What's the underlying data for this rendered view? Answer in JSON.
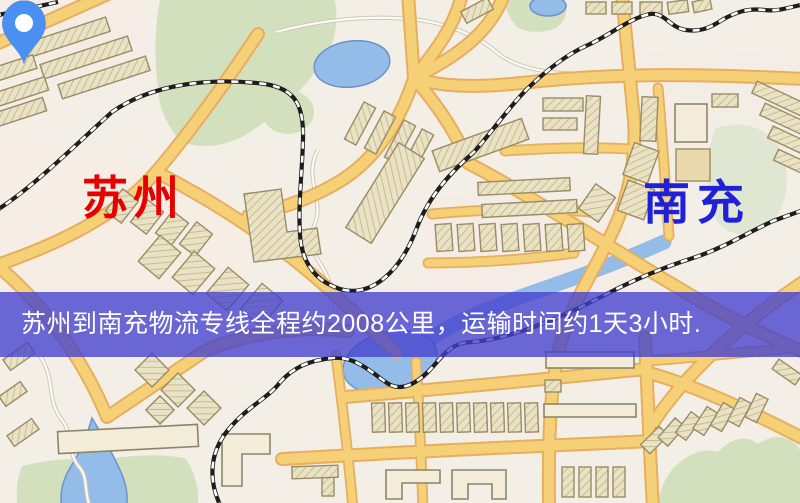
{
  "map": {
    "origin": {
      "name": "苏州",
      "marker_color": "#ee2a1d",
      "label_color": "#e60000"
    },
    "destination": {
      "name": "南充",
      "marker_color": "#4a8ff2",
      "label_color": "#2020d8"
    },
    "banner": {
      "text": "苏州到南充物流专线全程约2008公里，运输时间约1天3小时.",
      "bg_color": "#4340ce",
      "text_color": "#ffffff"
    },
    "palette": {
      "background": "#f3efe6",
      "road": "#f6d077",
      "road_casing": "#e7ae60",
      "park": "#d3e0bd",
      "water": "#93bce8",
      "building_fill": "#eae2c4",
      "building_stroke": "#998c66",
      "railway": "#1d1d1d"
    }
  }
}
